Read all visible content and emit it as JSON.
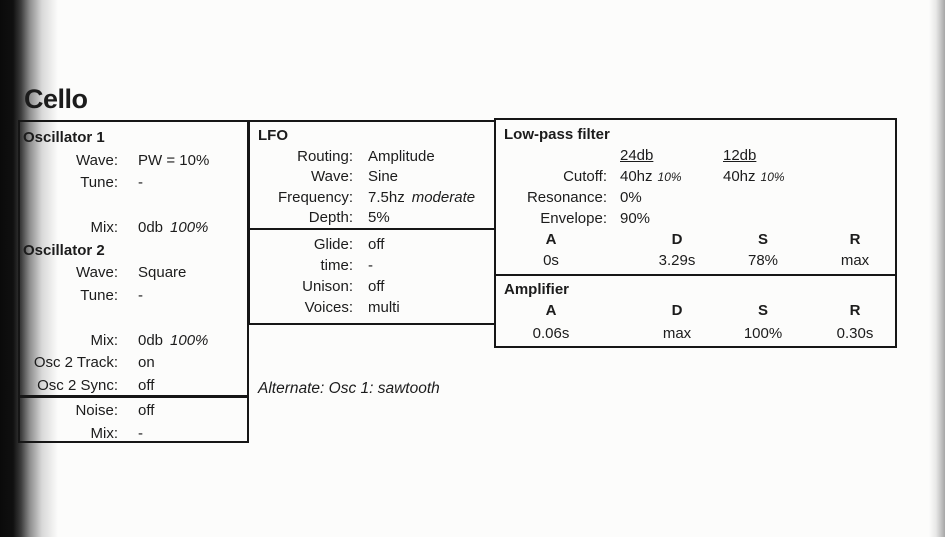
{
  "title": "Cello",
  "colors": {
    "ink": "#1c1c1c",
    "border": "#161616",
    "paper": "#fcfcfb",
    "binding": "#0a0a0a"
  },
  "osc": {
    "h1": "Oscillator 1",
    "r1": [
      {
        "label": "Wave:",
        "value": "PW = 10%"
      },
      {
        "label": "Tune:",
        "value": "-"
      },
      {
        "label": "Mix:",
        "value": "0db",
        "note": "100%"
      }
    ],
    "h2": "Oscillator 2",
    "r2": [
      {
        "label": "Wave:",
        "value": "Square"
      },
      {
        "label": "Tune:",
        "value": "-"
      },
      {
        "label": "Mix:",
        "value": "0db",
        "note": "100%"
      },
      {
        "label": "Osc 2 Track:",
        "value": "on"
      },
      {
        "label": "Osc 2 Sync:",
        "value": "off"
      }
    ]
  },
  "noise": {
    "rows": [
      {
        "label": "Noise:",
        "value": "off"
      },
      {
        "label": "Mix:",
        "value": "-"
      }
    ]
  },
  "lfo": {
    "h": "LFO",
    "rows": [
      {
        "label": "Routing:",
        "value": "Amplitude"
      },
      {
        "label": "Wave:",
        "value": "Sine"
      },
      {
        "label": "Frequency:",
        "value": "7.5hz",
        "note": "moderate"
      },
      {
        "label": "Depth:",
        "value": "5%"
      }
    ]
  },
  "glide": {
    "rows": [
      {
        "label": "Glide:",
        "value": "off"
      },
      {
        "label": "time:",
        "value": "-"
      },
      {
        "label": "Unison:",
        "value": "off"
      },
      {
        "label": "Voices:",
        "value": "multi"
      }
    ]
  },
  "alternate": "Alternate: Osc 1: sawtooth",
  "filter": {
    "h": "Low-pass filter",
    "slopes": [
      "24db",
      "12db"
    ],
    "cutoff": {
      "label": "Cutoff:",
      "value1": "40hz",
      "note1": "10%",
      "value2": "40hz",
      "note2": "10%"
    },
    "resonance": {
      "label": "Resonance:",
      "value": "0%"
    },
    "envelope": {
      "label": "Envelope:",
      "value": "90%"
    },
    "adsr_h": [
      "A",
      "D",
      "S",
      "R"
    ],
    "adsr_v": [
      "0s",
      "3.29s",
      "78%",
      "max"
    ]
  },
  "amp": {
    "h": "Amplifier",
    "adsr_h": [
      "A",
      "D",
      "S",
      "R"
    ],
    "adsr_v": [
      "0.06s",
      "max",
      "100%",
      "0.30s"
    ]
  }
}
